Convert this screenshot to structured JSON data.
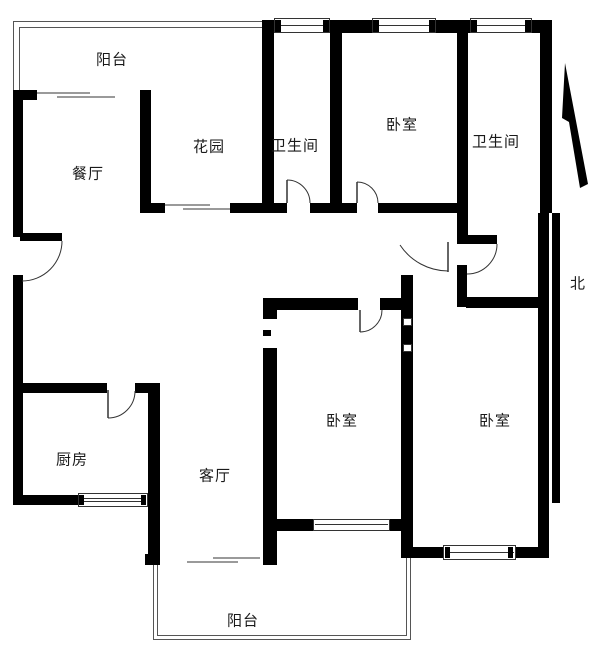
{
  "rooms": {
    "balcony_top": "阳台",
    "dining": "餐厅",
    "garden": "花园",
    "bath1": "卫生间",
    "bedroom1": "卧室",
    "bath2": "卫生间",
    "kitchen": "厨房",
    "living": "客厅",
    "bedroom2": "卧室",
    "bedroom3": "卧室",
    "balcony_bottom": "阳台"
  },
  "compass": {
    "north_label": "北"
  },
  "colors": {
    "wall": "#000000",
    "sill_line": "#9a9a9a",
    "railing_line": "#555555",
    "background": "#ffffff"
  }
}
